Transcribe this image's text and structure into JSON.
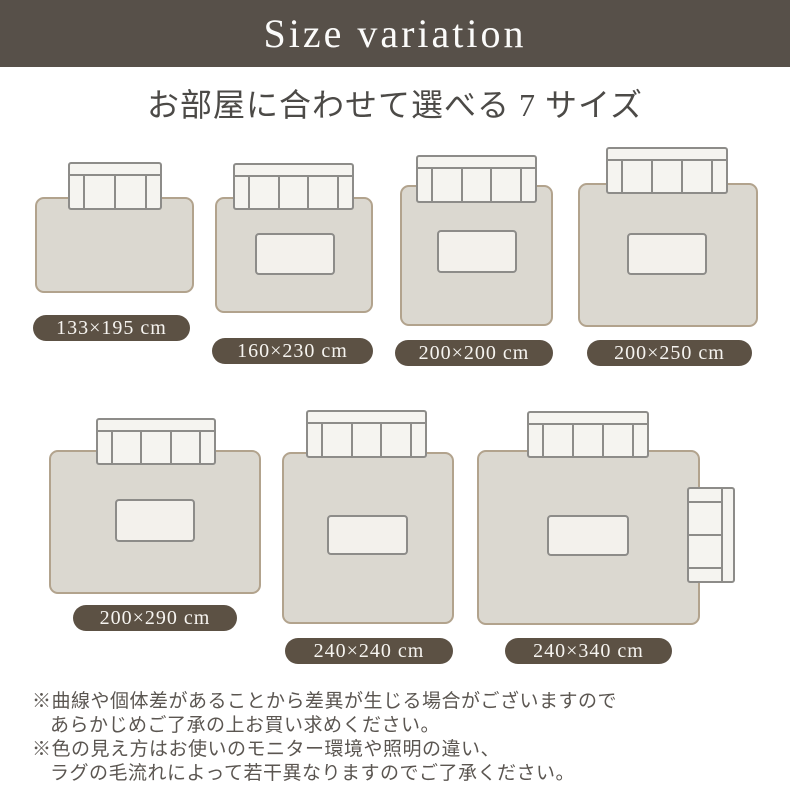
{
  "header": {
    "title": "Size variation"
  },
  "subtitle": "お部屋に合わせて選べる 7 サイズ",
  "sizes": [
    {
      "label": "133×195 cm",
      "sofa": "2-seater",
      "has_table": false,
      "side_sofa": false
    },
    {
      "label": "160×230 cm",
      "sofa": "3-seater",
      "has_table": true,
      "side_sofa": false
    },
    {
      "label": "200×200 cm",
      "sofa": "3-seater",
      "has_table": true,
      "side_sofa": false
    },
    {
      "label": "200×250 cm",
      "sofa": "3-seater",
      "has_table": true,
      "side_sofa": false
    },
    {
      "label": "200×290 cm",
      "sofa": "3-seater",
      "has_table": true,
      "side_sofa": false
    },
    {
      "label": "240×240 cm",
      "sofa": "3-seater",
      "has_table": true,
      "side_sofa": false
    },
    {
      "label": "240×340 cm",
      "sofa": "3-seater",
      "has_table": true,
      "side_sofa": true
    }
  ],
  "notes": [
    "※曲線や個体差があることから差異が生じる場合がございますので",
    "あらかじめご了承の上お買い求めください。",
    "※色の見え方はお使いのモニター環境や照明の違い、",
    "ラグの毛流れによって若干異なりますのでご了承ください。"
  ],
  "colors": {
    "header_bg": "#575049",
    "title_color": "#fbfbfa",
    "subtitle_color": "#4c4a47",
    "rug_fill": "#dbd8d0",
    "rug_border": "#b2a38d",
    "sofa_fill": "#f5f4f0",
    "sofa_border": "#8d8c89",
    "table_fill": "#f3f1ec",
    "pill_bg": "#5c5144",
    "pill_text": "#f6f4f0",
    "note_color": "#5b5651",
    "page_bg": "#ffffff"
  }
}
